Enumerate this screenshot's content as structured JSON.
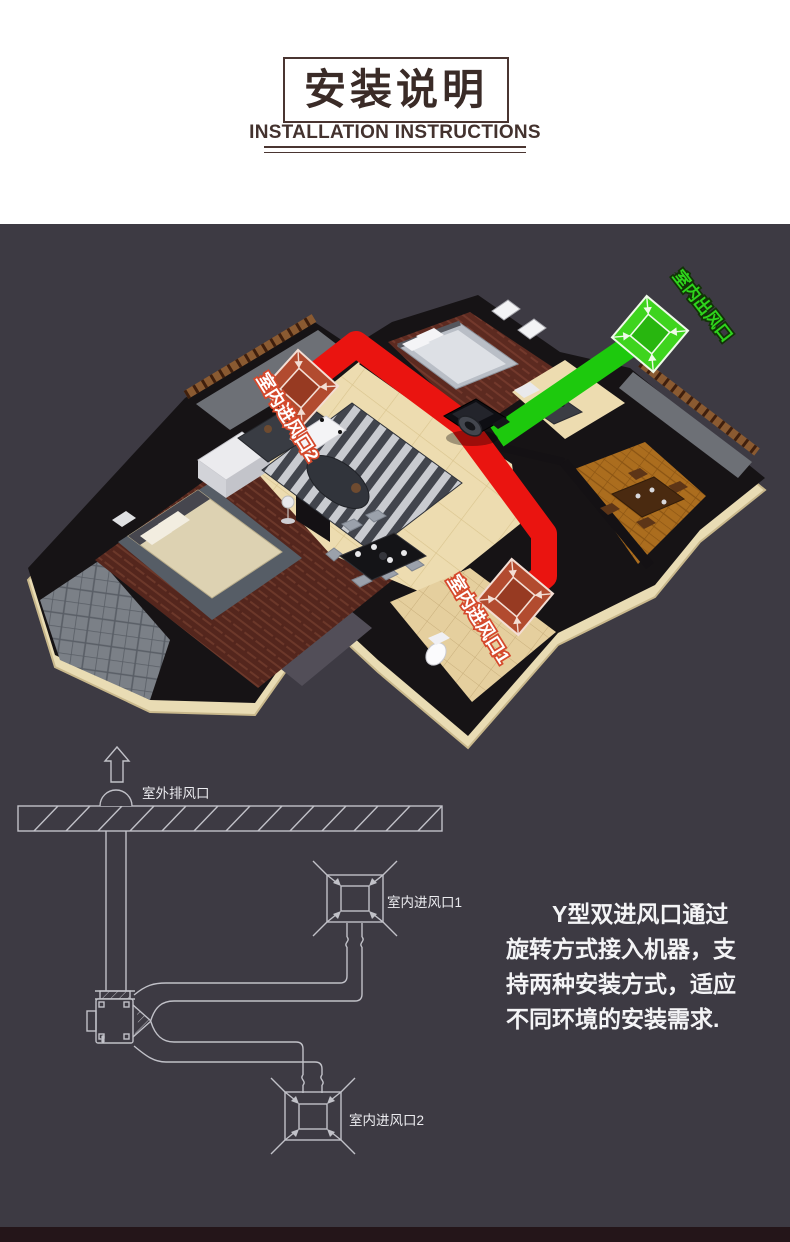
{
  "header": {
    "title": "安装说明",
    "subtitle": "INSTALLATION INSTRUCTIONS"
  },
  "house_diagram": {
    "labels": {
      "indoor_outlet": "室内出风口",
      "indoor_inlet_2": "室内进风口2",
      "indoor_inlet_1": "室内进风口1"
    }
  },
  "install_schematic": {
    "labels": {
      "outdoor_exhaust": "室外排风口",
      "indoor_inlet_1": "室内进风口1",
      "indoor_inlet_2": "室内进风口2"
    }
  },
  "instructions": {
    "lines": [
      "Y型双进风口通过",
      "旋转方式接入机器，支",
      "持两种安装方式，适应",
      "不同环境的安装需求."
    ]
  },
  "colors": {
    "background_dark": "#3d3a43",
    "footer_strip": "#241519",
    "title_brown": "#4a3531",
    "duct_red": "#ea1410",
    "duct_green": "#1dc90d",
    "schematic_line": "#c1c1c8"
  }
}
